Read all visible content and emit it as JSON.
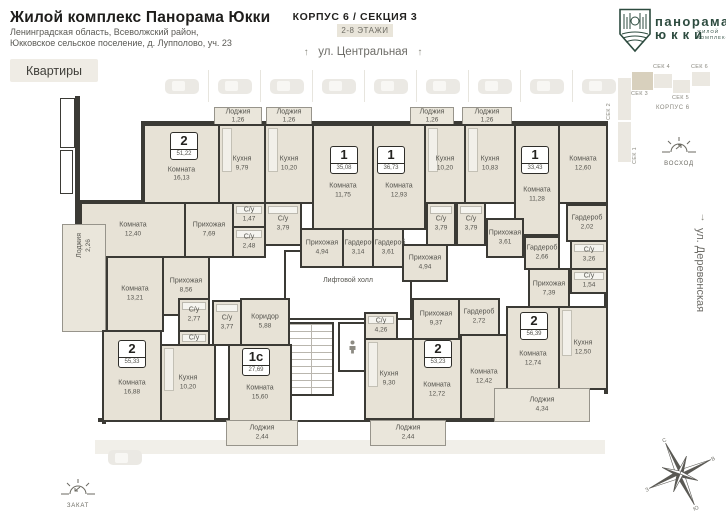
{
  "header": {
    "title": "Жилой комплекс Панорама Юкки",
    "address_line1": "Ленинградская область, Всеволжский район,",
    "address_line2": "Юкковское сельское поселение, д. Лупполово, уч. 23",
    "apartments_button": "Квартиры",
    "korpus_title": "КОРПУС 6 / СЕКЦИЯ 3",
    "floors_badge": "2-8 ЭТАЖИ"
  },
  "logo": {
    "line1": "панорама",
    "line2": "юкки",
    "sub1": "жилой",
    "sub2": "комплекс"
  },
  "streets": {
    "top": "ул. Центральная",
    "right": "ул. Деревенская"
  },
  "sun": {
    "east": "ВОСХОД",
    "west": "ЗАКАТ"
  },
  "compass": {
    "n": "С",
    "e": "В",
    "s": "Ю",
    "w": "З"
  },
  "minimap": {
    "korpus_label": "КОРПУС 6",
    "blocks": [
      {
        "label": "СЕК 2",
        "x": 618,
        "y": 78,
        "w": 13,
        "h": 42,
        "lx": 606,
        "ly": 80,
        "vert": true,
        "active": false
      },
      {
        "label": "СЕК 1",
        "x": 618,
        "y": 122,
        "w": 13,
        "h": 40,
        "lx": 632,
        "ly": 124,
        "vert": true,
        "active": false
      },
      {
        "label": "СЕК 3",
        "x": 632,
        "y": 72,
        "w": 21,
        "h": 18,
        "lx": 631,
        "ly": 91,
        "vert": false,
        "active": true
      },
      {
        "label": "СЕК 4",
        "x": 654,
        "y": 74,
        "w": 18,
        "h": 14,
        "lx": 653,
        "ly": 64,
        "vert": false,
        "active": false
      },
      {
        "label": "СЕК 5",
        "x": 673,
        "y": 80,
        "w": 17,
        "h": 13,
        "lx": 672,
        "ly": 95,
        "vert": false,
        "active": false
      },
      {
        "label": "СЕК 6",
        "x": 692,
        "y": 72,
        "w": 18,
        "h": 14,
        "lx": 691,
        "ly": 64,
        "vert": false,
        "active": false
      }
    ]
  },
  "plan": {
    "lift_hall_label": "Лифтовой холл",
    "badges": [
      {
        "num": "2",
        "area": "51,22",
        "x": 170,
        "y": 132
      },
      {
        "num": "1",
        "area": "35,08",
        "x": 330,
        "y": 146
      },
      {
        "num": "1",
        "area": "36,73",
        "x": 377,
        "y": 146
      },
      {
        "num": "1",
        "area": "33,43",
        "x": 521,
        "y": 146
      },
      {
        "num": "2",
        "area": "55,33",
        "x": 118,
        "y": 340
      },
      {
        "num": "1с",
        "area": "27,69",
        "x": 242,
        "y": 348
      },
      {
        "num": "2",
        "area": "53,23",
        "x": 424,
        "y": 340
      },
      {
        "num": "2",
        "area": "56,39",
        "x": 520,
        "y": 312
      }
    ],
    "rooms": [
      {
        "name": "Лоджия",
        "area": "1,26",
        "x": 214,
        "y": 107,
        "w": 48,
        "h": 19,
        "type": "loggia"
      },
      {
        "name": "Лоджия",
        "area": "1,26",
        "x": 266,
        "y": 107,
        "w": 46,
        "h": 19,
        "type": "loggia"
      },
      {
        "name": "Лоджия",
        "area": "1,26",
        "x": 410,
        "y": 107,
        "w": 44,
        "h": 19,
        "type": "loggia"
      },
      {
        "name": "Лоджия",
        "area": "1,26",
        "x": 462,
        "y": 107,
        "w": 50,
        "h": 19,
        "type": "loggia"
      },
      {
        "name": "Комната",
        "area": "16,13",
        "x": 143,
        "y": 124,
        "w": 77,
        "h": 80,
        "type": "room",
        "lpos": "low"
      },
      {
        "name": "Кухня",
        "area": "9,79",
        "x": 218,
        "y": 124,
        "w": 48,
        "h": 80,
        "type": "kitchen"
      },
      {
        "name": "Кухня",
        "area": "10,20",
        "x": 264,
        "y": 124,
        "w": 50,
        "h": 80,
        "type": "kitchen"
      },
      {
        "name": "Комната",
        "area": "11,75",
        "x": 312,
        "y": 124,
        "w": 62,
        "h": 106,
        "type": "room",
        "lpos": "low"
      },
      {
        "name": "Комната",
        "area": "12,93",
        "x": 372,
        "y": 124,
        "w": 54,
        "h": 106,
        "type": "room",
        "lpos": "low"
      },
      {
        "name": "Кухня",
        "area": "10,20",
        "x": 424,
        "y": 124,
        "w": 42,
        "h": 80,
        "type": "kitchen"
      },
      {
        "name": "Кухня",
        "area": "10,83",
        "x": 464,
        "y": 124,
        "w": 52,
        "h": 80,
        "type": "kitchen"
      },
      {
        "name": "Комната",
        "area": "11,28",
        "x": 514,
        "y": 124,
        "w": 46,
        "h": 112,
        "type": "room",
        "lpos": "low"
      },
      {
        "name": "Комната",
        "area": "12,60",
        "x": 558,
        "y": 124,
        "w": 50,
        "h": 80,
        "type": "room"
      },
      {
        "name": "Комната",
        "area": "12,40",
        "x": 80,
        "y": 202,
        "w": 106,
        "h": 56,
        "type": "room"
      },
      {
        "name": "Прихожая",
        "area": "7,69",
        "x": 184,
        "y": 202,
        "w": 50,
        "h": 56,
        "type": "room"
      },
      {
        "name": "С/у",
        "area": "1,47",
        "x": 232,
        "y": 202,
        "w": 34,
        "h": 26,
        "type": "wet"
      },
      {
        "name": "С/у",
        "area": "2,48",
        "x": 232,
        "y": 226,
        "w": 34,
        "h": 32,
        "type": "wet"
      },
      {
        "name": "С/у",
        "area": "3,79",
        "x": 264,
        "y": 202,
        "w": 38,
        "h": 44,
        "type": "wet"
      },
      {
        "name": "Прихожая",
        "area": "4,94",
        "x": 300,
        "y": 228,
        "w": 44,
        "h": 40,
        "type": "room"
      },
      {
        "name": "Гардероб",
        "area": "3,14",
        "x": 342,
        "y": 228,
        "w": 32,
        "h": 40,
        "type": "room"
      },
      {
        "name": "Гардероб",
        "area": "3,61",
        "x": 372,
        "y": 228,
        "w": 32,
        "h": 40,
        "type": "room"
      },
      {
        "name": "С/у",
        "area": "3,79",
        "x": 426,
        "y": 202,
        "w": 30,
        "h": 44,
        "type": "wet"
      },
      {
        "name": "С/у",
        "area": "3,79",
        "x": 456,
        "y": 202,
        "w": 30,
        "h": 44,
        "type": "wet"
      },
      {
        "name": "Прихожая",
        "area": "4,94",
        "x": 402,
        "y": 244,
        "w": 46,
        "h": 38,
        "type": "room"
      },
      {
        "name": "Прихожая",
        "area": "3,61",
        "x": 486,
        "y": 218,
        "w": 38,
        "h": 40,
        "type": "room"
      },
      {
        "name": "Гардероб",
        "area": "2,66",
        "x": 524,
        "y": 236,
        "w": 36,
        "h": 34,
        "type": "room"
      },
      {
        "name": "Гардероб",
        "area": "2,02",
        "x": 566,
        "y": 204,
        "w": 42,
        "h": 38,
        "type": "room"
      },
      {
        "name": "С/у",
        "area": "3,26",
        "x": 570,
        "y": 240,
        "w": 38,
        "h": 30,
        "type": "wet"
      },
      {
        "name": "С/у",
        "area": "1,54",
        "x": 570,
        "y": 268,
        "w": 38,
        "h": 26,
        "type": "wet"
      },
      {
        "name": "Прихожая",
        "area": "7,39",
        "x": 528,
        "y": 268,
        "w": 42,
        "h": 42,
        "type": "room"
      },
      {
        "name": "Лоджия",
        "area": "2,26",
        "x": 62,
        "y": 224,
        "w": 44,
        "h": 108,
        "type": "loggia",
        "vert": true
      },
      {
        "name": "Комната",
        "area": "13,21",
        "x": 106,
        "y": 256,
        "w": 58,
        "h": 76,
        "type": "room"
      },
      {
        "name": "Прихожая",
        "area": "8,56",
        "x": 162,
        "y": 256,
        "w": 48,
        "h": 60,
        "type": "room"
      },
      {
        "name": "С/у",
        "area": "2,77",
        "x": 178,
        "y": 298,
        "w": 32,
        "h": 34,
        "type": "wet"
      },
      {
        "name": "С/у",
        "area": "1,69",
        "x": 178,
        "y": 330,
        "w": 32,
        "h": 26,
        "type": "wet"
      },
      {
        "name": "Комната",
        "area": "16,88",
        "x": 102,
        "y": 330,
        "w": 60,
        "h": 92,
        "type": "room",
        "lpos": "low"
      },
      {
        "name": "Кухня",
        "area": "10,20",
        "x": 160,
        "y": 344,
        "w": 56,
        "h": 78,
        "type": "kitchen"
      },
      {
        "name": "С/у",
        "area": "3,77",
        "x": 212,
        "y": 300,
        "w": 30,
        "h": 46,
        "type": "wet"
      },
      {
        "name": "Коридор",
        "area": "5,88",
        "x": 240,
        "y": 298,
        "w": 50,
        "h": 48,
        "type": "room"
      },
      {
        "name": "Комната",
        "area": "15,60",
        "x": 228,
        "y": 344,
        "w": 64,
        "h": 78,
        "type": "room",
        "lpos": "low"
      },
      {
        "name": "Лоджия",
        "area": "2,44",
        "x": 226,
        "y": 420,
        "w": 72,
        "h": 26,
        "type": "loggia"
      },
      {
        "name": "С/у",
        "area": "4,26",
        "x": 364,
        "y": 312,
        "w": 34,
        "h": 28,
        "type": "wet"
      },
      {
        "name": "Кухня",
        "area": "9,30",
        "x": 364,
        "y": 338,
        "w": 50,
        "h": 82,
        "type": "kitchen"
      },
      {
        "name": "Прихожая",
        "area": "9,37",
        "x": 412,
        "y": 298,
        "w": 48,
        "h": 42,
        "type": "room"
      },
      {
        "name": "Гардероб",
        "area": "2,72",
        "x": 458,
        "y": 298,
        "w": 42,
        "h": 38,
        "type": "room"
      },
      {
        "name": "Комната",
        "area": "12,72",
        "x": 412,
        "y": 338,
        "w": 50,
        "h": 82,
        "type": "room",
        "lpos": "low"
      },
      {
        "name": "Комната",
        "area": "12,42",
        "x": 460,
        "y": 334,
        "w": 48,
        "h": 86,
        "type": "room"
      },
      {
        "name": "Лоджия",
        "area": "2,44",
        "x": 370,
        "y": 420,
        "w": 76,
        "h": 26,
        "type": "loggia"
      },
      {
        "name": "Комната",
        "area": "12,74",
        "x": 506,
        "y": 306,
        "w": 54,
        "h": 84,
        "type": "room",
        "lpos": "low"
      },
      {
        "name": "Кухня",
        "area": "12,50",
        "x": 558,
        "y": 306,
        "w": 50,
        "h": 84,
        "type": "kitchen"
      },
      {
        "name": "Лоджия",
        "area": "4,34",
        "x": 494,
        "y": 388,
        "w": 96,
        "h": 34,
        "type": "loggia"
      }
    ]
  },
  "parking": {
    "top_spots": 9,
    "bottom_spots": 1
  }
}
